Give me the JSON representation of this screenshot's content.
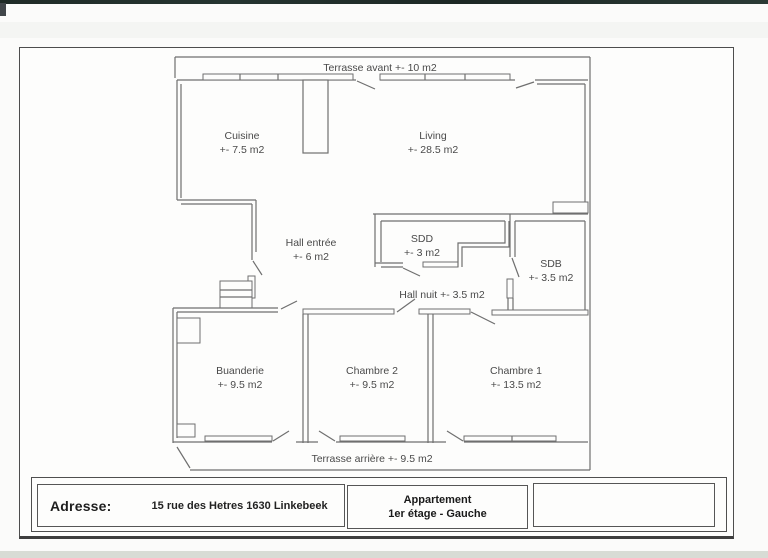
{
  "rooms": {
    "terrasse_avant": {
      "label": "Terrasse avant +- 10 m2"
    },
    "cuisine": {
      "name": "Cuisine",
      "area": "+- 7.5 m2"
    },
    "living": {
      "name": "Living",
      "area": "+- 28.5 m2"
    },
    "hall_entree": {
      "name": "Hall entrée",
      "area": "+- 6 m2"
    },
    "sdd": {
      "name": "SDD",
      "area": "+- 3 m2"
    },
    "sdb": {
      "name": "SDB",
      "area": "+- 3.5 m2"
    },
    "hall_nuit": {
      "label": "Hall nuit +- 3.5 m2"
    },
    "buanderie": {
      "name": "Buanderie",
      "area": "+- 9.5 m2"
    },
    "chambre2": {
      "name": "Chambre 2",
      "area": "+- 9.5 m2"
    },
    "chambre1": {
      "name": "Chambre 1",
      "area": "+- 13.5 m2"
    },
    "terrasse_arriere": {
      "label": "Terrasse arrière +- 9.5 m2"
    }
  },
  "footer": {
    "address_label": "Adresse:",
    "address_value": "15 rue des Hetres 1630 Linkebeek",
    "unit_line1": "Appartement",
    "unit_line2": "1er étage - Gauche"
  },
  "colors": {
    "plan_line": "#6f6f6f",
    "plan_text": "#4a4a4a",
    "footer_text": "#1e1e1e",
    "scan_bar": "#22302c",
    "paper": "#fdfdfc"
  }
}
